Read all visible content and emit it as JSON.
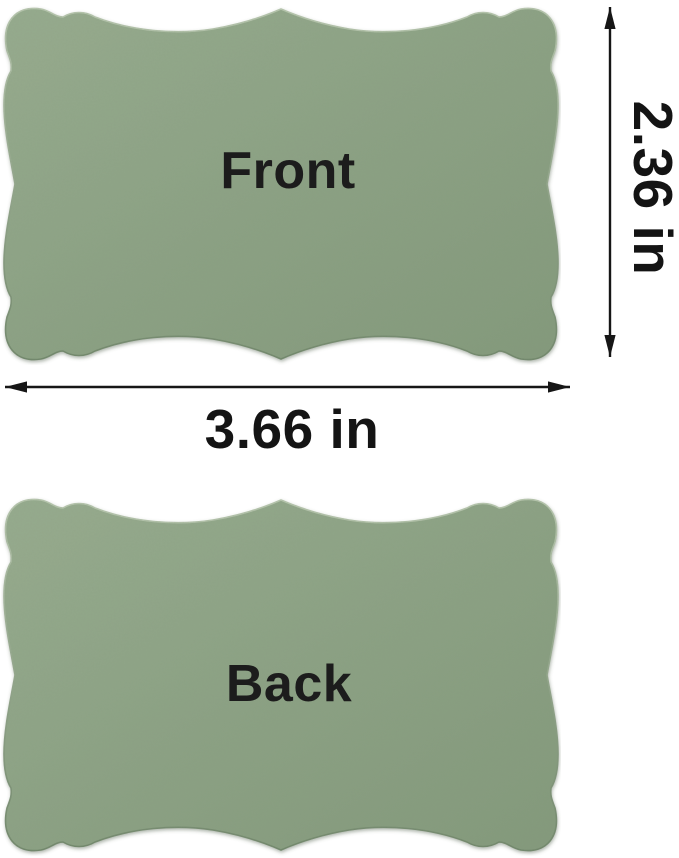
{
  "cards": {
    "front": {
      "label": "Front"
    },
    "back": {
      "label": "Back"
    }
  },
  "dimensions": {
    "height": "2.36 in",
    "width": "3.66 in"
  },
  "colors": {
    "card_green": "#8ca284",
    "card_green_light": "#97ac8f",
    "card_green_dark": "#83997b",
    "label_text": "#1c1c1c",
    "arrow": "#161616",
    "background": "#ffffff"
  }
}
